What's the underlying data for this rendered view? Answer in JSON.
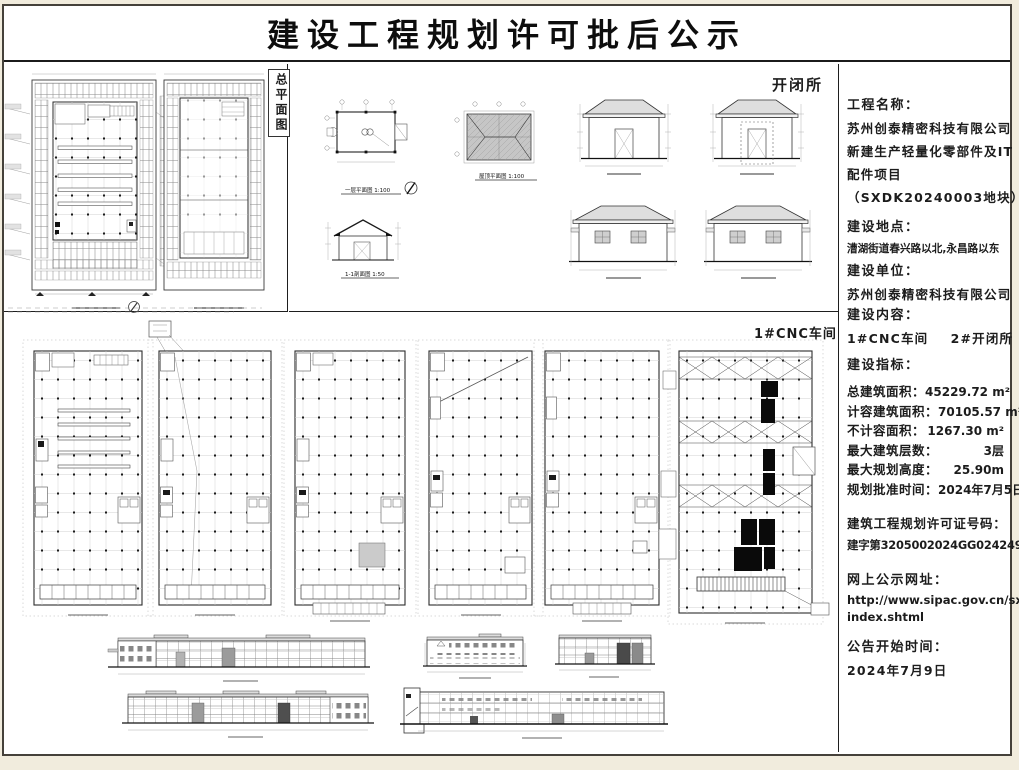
{
  "page": {
    "title": "建设工程规划许可批后公示"
  },
  "sections": {
    "site_plan": {
      "side_label": "总平面图"
    },
    "switch_station": {
      "label": "开闭所",
      "captions": {
        "floor_plan": "一层平面图 1:100",
        "roof_plan": "屋顶平面图 1:100",
        "section": "1-1剖面图 1:50"
      }
    },
    "workshop": {
      "label": "1#CNC车间"
    }
  },
  "info_panel": {
    "project_name_label": "工程名称：",
    "project_name_lines": [
      "苏州创泰精密科技有限公司",
      "新建生产轻量化零部件及IT",
      "配件项目",
      "（SXDK20240003地块）"
    ],
    "location_label": "建设地点：",
    "location": "漕湖街道春兴路以北,永昌路以东",
    "unit_label": "建设单位：",
    "unit": "苏州创泰精密科技有限公司",
    "content_label": "建设内容：",
    "content": "1#CNC车间    2#开闭所",
    "indicators_label": "建设指标：",
    "indicators": [
      {
        "label": "总建筑面积：",
        "value": "45229.72 m²"
      },
      {
        "label": "计容建筑面积：",
        "value": "70105.57 m²"
      },
      {
        "label": "不计容面积：",
        "value": "1267.30 m²"
      },
      {
        "label": "最大建筑层数：",
        "value": "3层"
      },
      {
        "label": "最大规划高度：",
        "value": "25.90m"
      },
      {
        "label": "规划批准时间：",
        "value": "2024年7月5日"
      }
    ],
    "permit_label": "建筑工程规划许可证号码：",
    "permit_number": "建字第3205002024GG0242497号",
    "website_label": "网上公示网址：",
    "website_lines": [
      "http://www.sipac.gov.cn/sxhzq/",
      "index.shtml"
    ],
    "announce_label": "公告开始时间：",
    "announce_date": "2024年7月9日"
  }
}
